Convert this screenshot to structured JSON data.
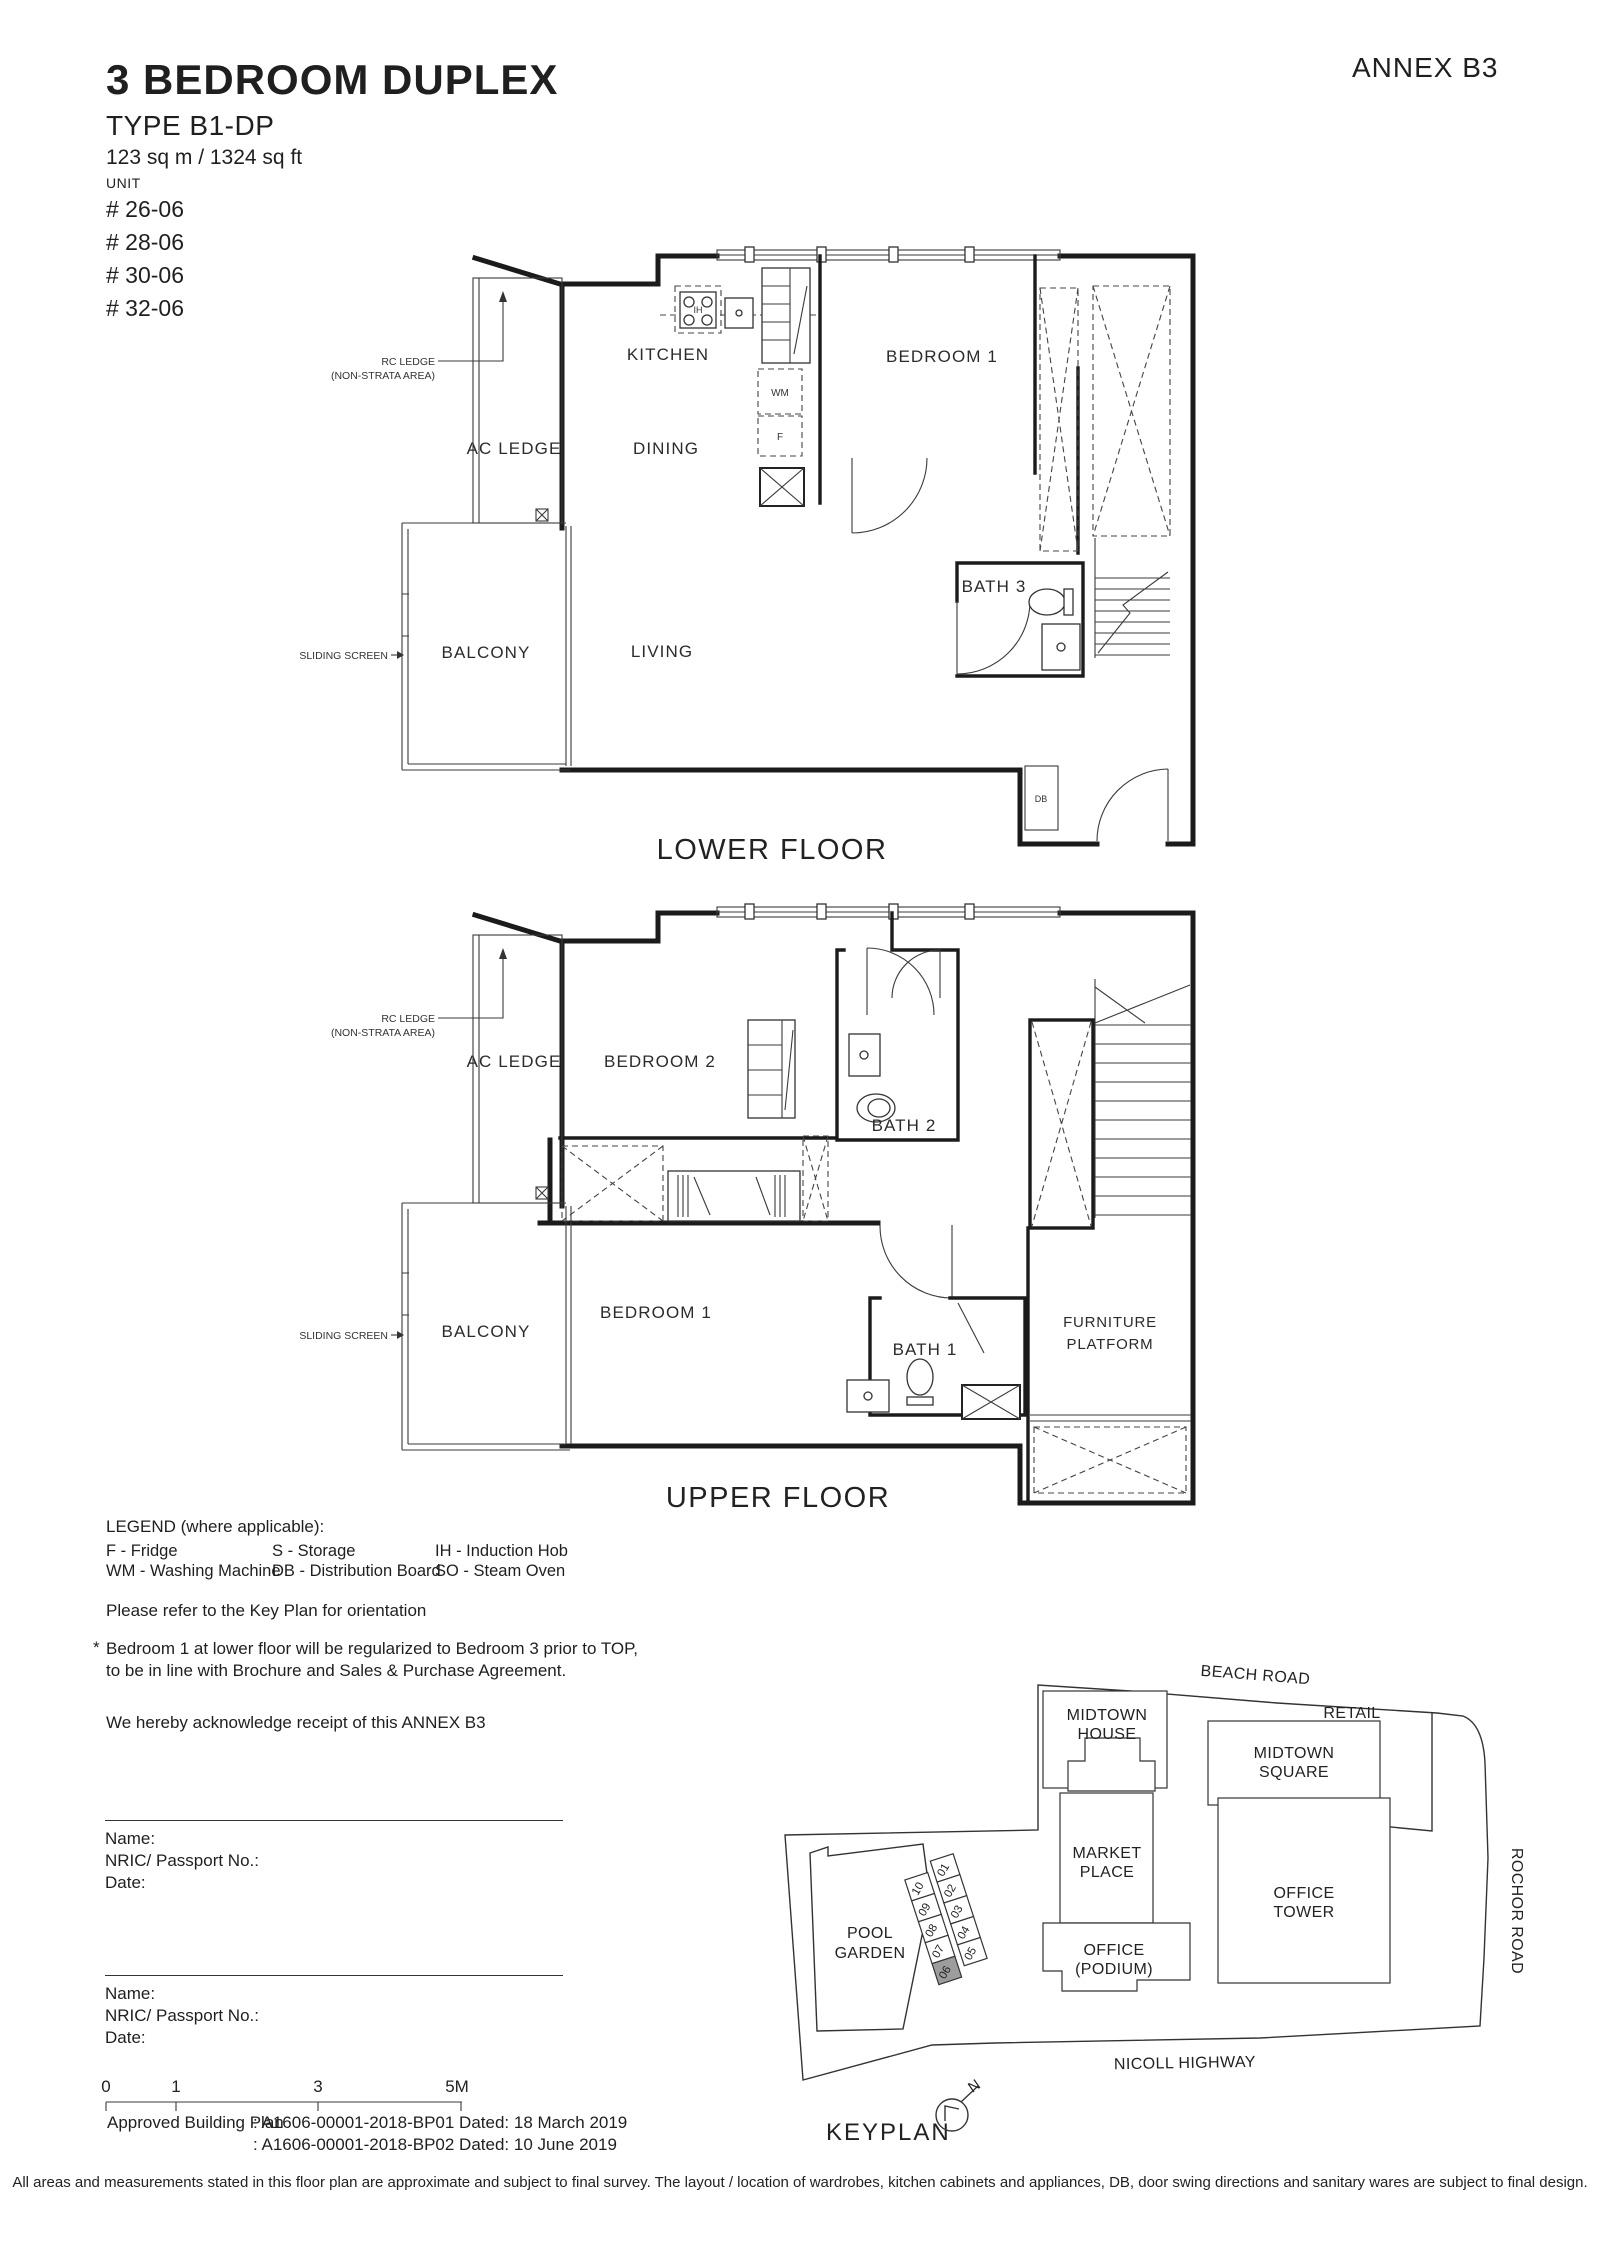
{
  "header": {
    "title": "3 BEDROOM DUPLEX",
    "type": "TYPE B1-DP",
    "area": "123 sq m / 1324 sq ft",
    "unit_label": "UNIT",
    "units": [
      "# 26-06",
      "# 28-06",
      "# 30-06",
      "# 32-06"
    ],
    "annex": "ANNEX B3"
  },
  "lower": {
    "caption": "LOWER FLOOR",
    "kitchen": "KITCHEN",
    "dining": "DINING",
    "living": "LIVING",
    "balcony": "BALCONY",
    "ac_ledge": "AC LEDGE",
    "rc_ledge_1": "RC LEDGE",
    "rc_ledge_2": "(NON-STRATA AREA)",
    "sliding_screen": "SLIDING SCREEN",
    "bedroom1": "BEDROOM 1",
    "bath3": "BATH 3",
    "wm": "WM",
    "f": "F",
    "ih": "IH",
    "db": "DB"
  },
  "upper": {
    "caption": "UPPER FLOOR",
    "bedroom2": "BEDROOM 2",
    "bedroom1": "BEDROOM 1",
    "bath1": "BATH 1",
    "bath2": "BATH 2",
    "balcony": "BALCONY",
    "ac_ledge": "AC LEDGE",
    "rc_ledge_1": "RC LEDGE",
    "rc_ledge_2": "(NON-STRATA AREA)",
    "sliding_screen": "SLIDING SCREEN",
    "furniture_1": "FURNITURE",
    "furniture_2": "PLATFORM"
  },
  "legend": {
    "title": "LEGEND (where applicable):",
    "f": "F - Fridge",
    "wm": "WM - Washing Machine",
    "s": "S - Storage",
    "db": "DB - Distribution Board",
    "ih": "IH - Induction Hob",
    "so": "SO - Steam Oven"
  },
  "notes": {
    "orientation": "Please refer to the Key Plan for orientation",
    "star": "*",
    "reg1": "Bedroom 1 at lower floor will be regularized to Bedroom 3 prior to TOP,",
    "reg2": "to be in line with Brochure and Sales & Purchase Agreement.",
    "ack": "We hereby acknowledge receipt of this ANNEX B3"
  },
  "signatures": [
    {
      "name": "Name:",
      "nric": "NRIC/ Passport No.:",
      "date": "Date:"
    },
    {
      "name": "Name:",
      "nric": "NRIC/ Passport No.:",
      "date": "Date:"
    }
  ],
  "scale": {
    "t0": "0",
    "t1": "1",
    "t3": "3",
    "t5": "5M"
  },
  "approval": {
    "label": "Approved Building Plan",
    "line1": ": A1606-00001-2018-BP01  Dated: 18 March 2019",
    "line2": ": A1606-00001-2018-BP02 Dated: 10 June 2019"
  },
  "keyplan": {
    "caption": "KEYPLAN",
    "north": "N",
    "beach": "BEACH ROAD",
    "rochor": "ROCHOR ROAD",
    "nicoll": "NICOLL HIGHWAY",
    "midtown_house_1": "MIDTOWN",
    "midtown_house_2": "HOUSE",
    "retail": "RETAIL",
    "square_1": "MIDTOWN",
    "square_2": "SQUARE",
    "market_1": "MARKET",
    "market_2": "PLACE",
    "tower_1": "OFFICE",
    "tower_2": "TOWER",
    "podium_1": "OFFICE",
    "podium_2": "(PODIUM)",
    "pool_1": "POOL",
    "pool_2": "GARDEN",
    "units": [
      "01",
      "02",
      "03",
      "04",
      "05",
      "06",
      "07",
      "08",
      "09",
      "10"
    ],
    "highlight_unit": "06",
    "highlight_color": "#9d9d9d"
  },
  "disclaimer": "All areas and measurements stated in this floor plan are approximate and subject to final survey. The layout / location of wardrobes, kitchen cabinets and appliances, DB, door swing directions and sanitary wares are subject to final design."
}
